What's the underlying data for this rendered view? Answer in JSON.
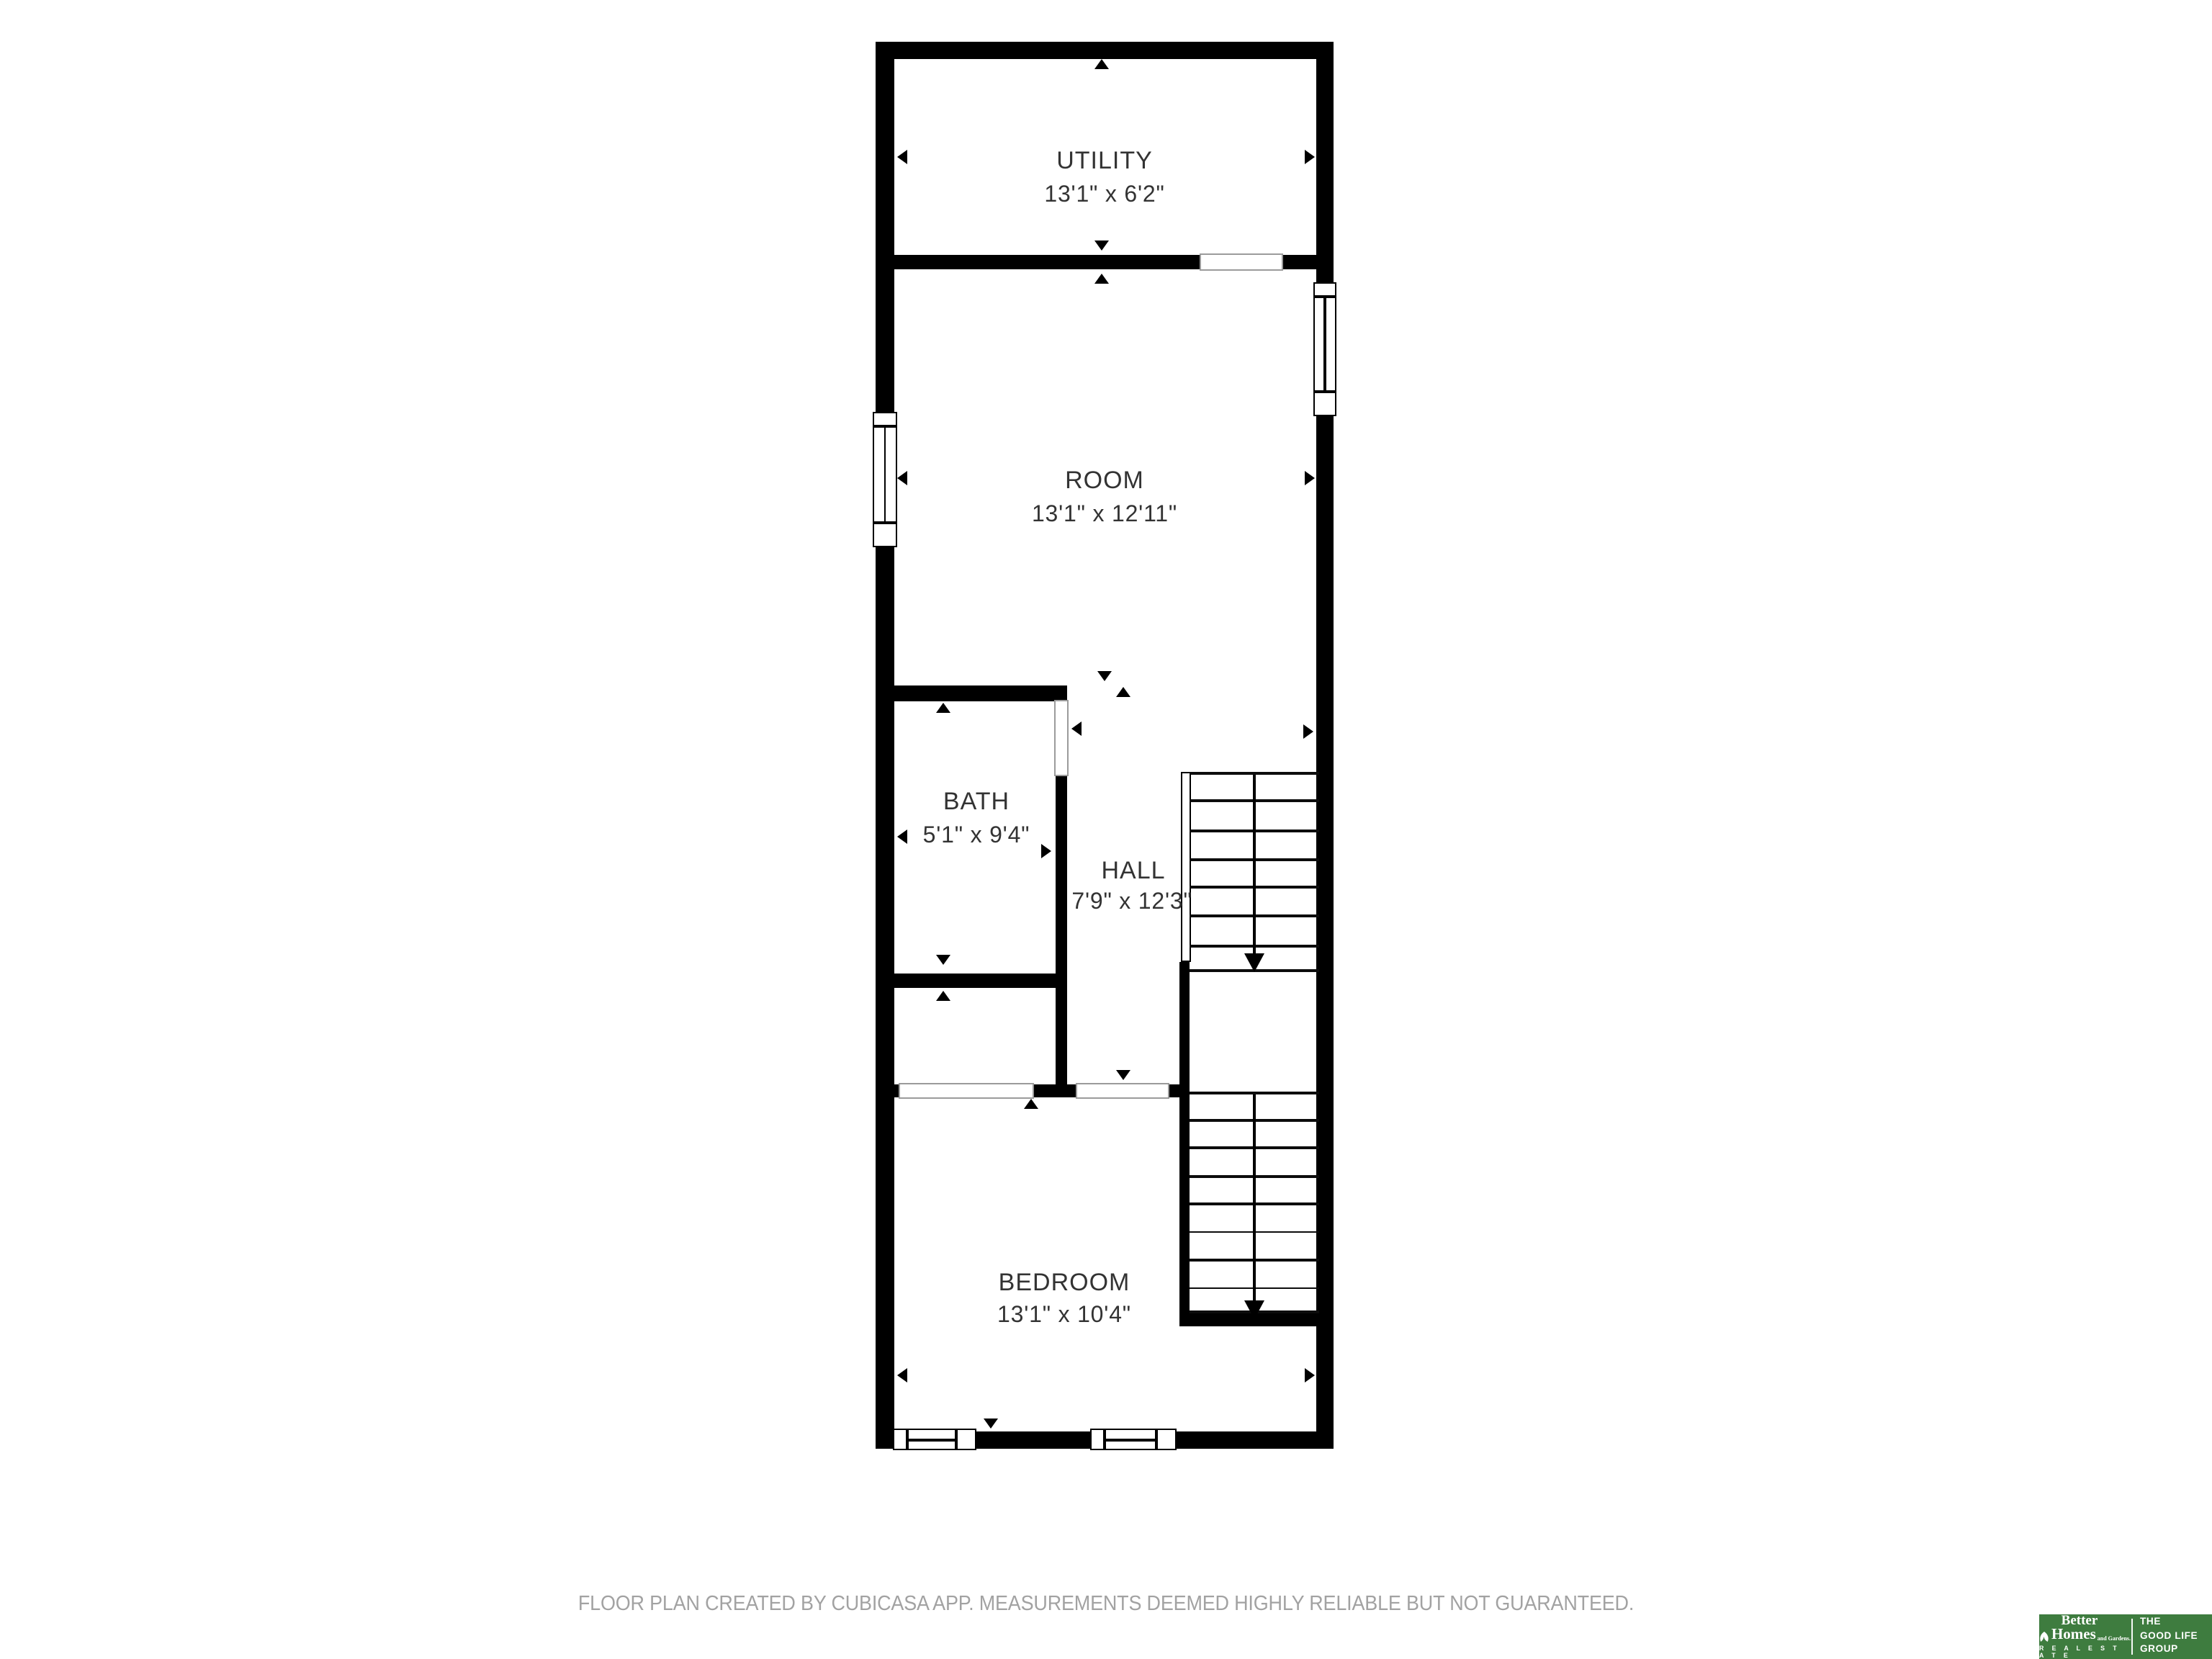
{
  "floorplan": {
    "rooms": [
      {
        "name": "UTILITY",
        "dimensions": "13'1\" x 6'2\""
      },
      {
        "name": "ROOM",
        "dimensions": "13'1\" x 12'11\""
      },
      {
        "name": "BATH",
        "dimensions": "5'1\" x 9'4\""
      },
      {
        "name": "HALL",
        "dimensions": "7'9\" x 12'3\""
      },
      {
        "name": "BEDROOM",
        "dimensions": "13'1\" x 10'4\""
      }
    ],
    "stairs": {
      "upper_flight_treads": 7,
      "lower_flight_treads": 8,
      "direction": "down"
    },
    "windows": {
      "room_left_wall": 1,
      "room_right_wall": 1,
      "bedroom_bottom_wall": 2
    }
  },
  "footer": {
    "disclaimer": "FLOOR PLAN CREATED BY CUBICASA APP. MEASUREMENTS DEEMED HIGHLY RELIABLE BUT NOT GUARANTEED."
  },
  "logo": {
    "brand_top": "Better",
    "brand_main": "Homes",
    "brand_sub": "and Gardens.",
    "brand_bottom": "R E A L   E S T A T E",
    "tagline_1": "THE",
    "tagline_2": "GOOD LIFE",
    "tagline_3": "GROUP"
  },
  "colors": {
    "wall": "#000000",
    "room_label": "#333333",
    "footer_text": "#A2A2A2",
    "logo_green": "#3E7C3F",
    "background": "#FFFFFF"
  }
}
